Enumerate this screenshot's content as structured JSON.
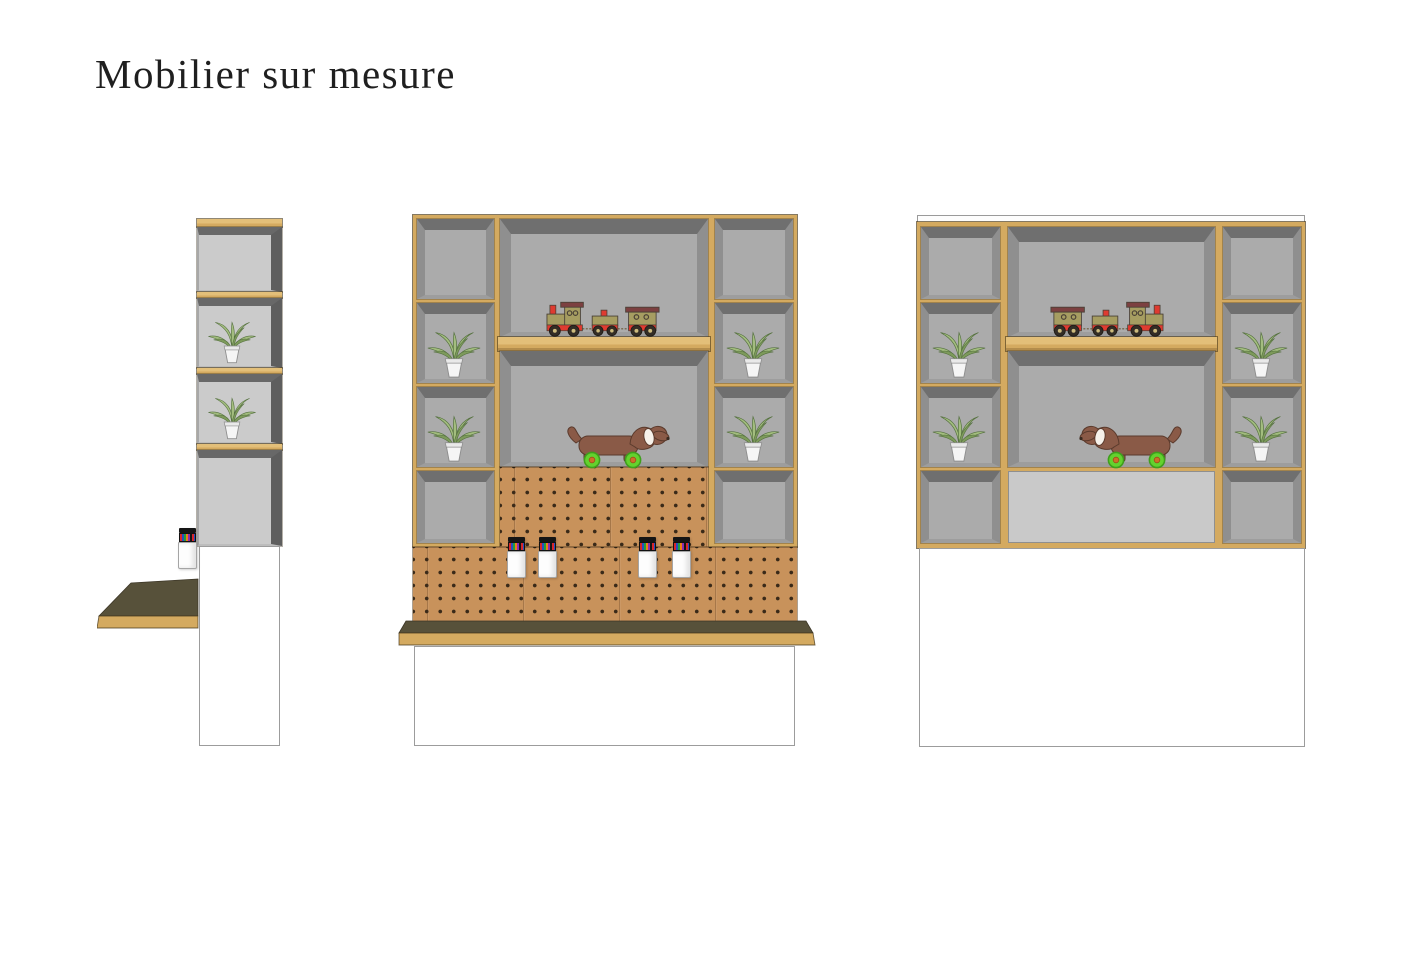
{
  "title": "Mobilier sur mesure",
  "colors": {
    "wood": "#d4aa60",
    "wood_light": "#e3bf79",
    "wood_dark": "#b38a47",
    "cell_gray": "#ababab",
    "cell_gray_side": "#cbcbcb",
    "bevel_dark": "#6f6f6f",
    "bevel_mid": "#8f8f8f",
    "bevel_low": "#9d9d9d",
    "outer_dark": "#5e5e5e",
    "pegboard": "#c8925b",
    "peg_hole": "#3a2a19",
    "counter_top": "#57513a",
    "panel_light": "#c9c9c9",
    "base_border": "#9c9c9c",
    "leaf": "#a3bd7f",
    "leaf_dark": "#7d9a5b",
    "leaf_line": "#55713f",
    "pot": "#f5f5f5",
    "train_body": "#a69d61",
    "train_roof": "#7c4040",
    "train_red": "#df3b30",
    "train_wheel": "#332d26",
    "train_hub": "#cdbb7d",
    "dog_body": "#8a5a47",
    "dog_line": "#5a3a2c",
    "dog_ear": "#f6f1ea",
    "dog_wheel": "#63d22e",
    "dog_wheel_rim": "#3f9f1c",
    "dog_hub": "#cd7029",
    "ink_line": "#4a4136"
  },
  "views": {
    "side": {
      "potted_plants": 2,
      "marker_jars": 1,
      "desk_top": true,
      "base_cabinet": true,
      "shelf_cells": 4
    },
    "front": {
      "potted_plants": 4,
      "marker_jars": 4,
      "toy_train": true,
      "toy_dog_on_wheels": true,
      "pegboard": true,
      "counter_top": true,
      "base_cabinet": true
    },
    "back": {
      "potted_plants": 4,
      "toy_train": true,
      "toy_dog_on_wheels": true,
      "back_panel": true,
      "base_cabinet": true
    }
  }
}
